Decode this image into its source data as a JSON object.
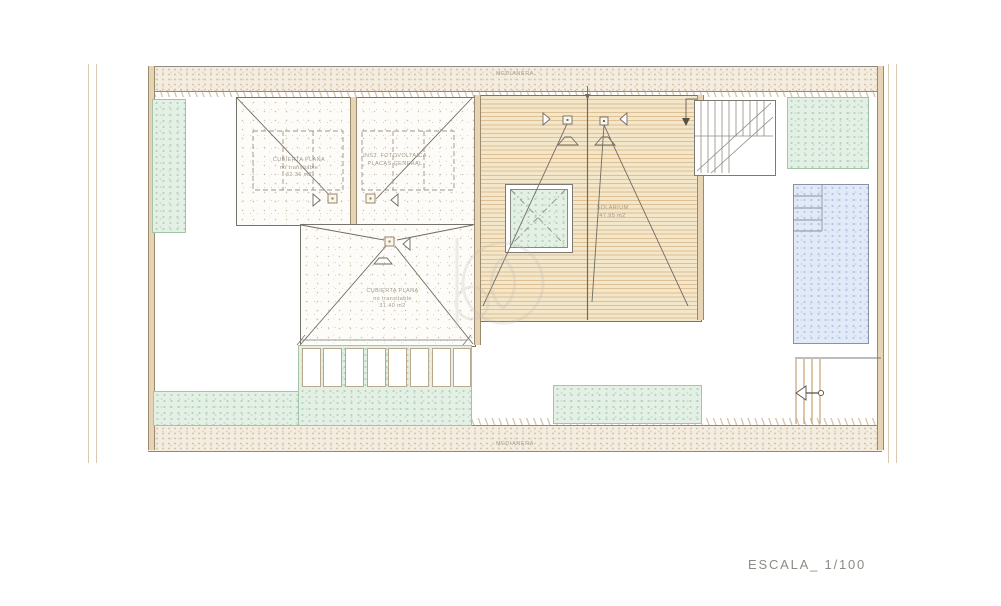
{
  "title": "Roof plan drawing",
  "labels": {
    "medianera_top": "MEDIANERA",
    "medianera_bottom": "MEDIANERA",
    "scale": "ESCALA_ 1/100",
    "roof_left": {
      "line1": "CUBIERTA PLANA",
      "line2": "no transitable",
      "line3": "32.36 m2"
    },
    "roof_pv": {
      "line1": "INST. FOTOVOLTAICA",
      "line2": "PLACAS GENERAL"
    },
    "roof_mid": {
      "line1": "CUBIERTA PLANA",
      "line2": "no transitable",
      "line3": "31.40 m2"
    },
    "solarium": {
      "line1": "SOLARIUM",
      "line2": "47.95 m2"
    }
  },
  "colors": {
    "deck_bg": "#f4e6c9",
    "deck_stripe": "#ddc096",
    "green_fill": "#e4f0e5",
    "green_dot": "#b2d4b8",
    "pool_fill": "#e1eaf6",
    "pool_dot": "#b2c8e6",
    "wall": "#e7d4b5",
    "line": "#76736c",
    "label_text": "#a19a8b",
    "scale_text": "#8c8c85"
  }
}
